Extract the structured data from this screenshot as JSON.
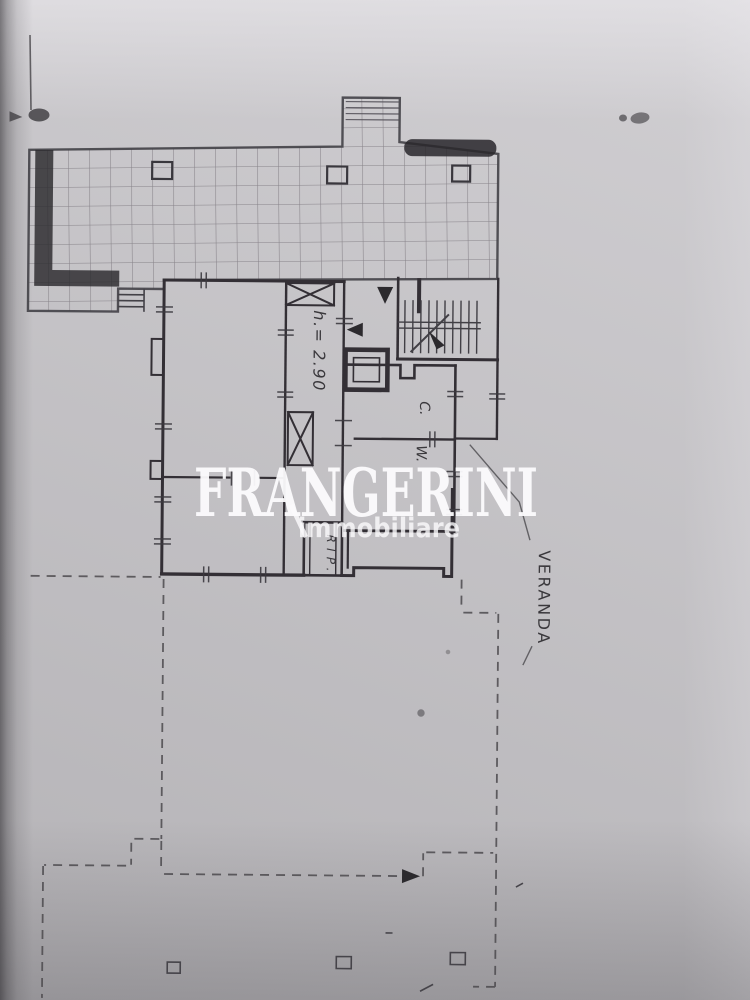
{
  "photo": {
    "description": "scanned architectural floor plan page"
  },
  "watermark": {
    "name": "FRANGERINI",
    "tagline": "immobiliare"
  },
  "labels": {
    "height": "h.= 2.90",
    "kitchen": "C.",
    "wc": "W.",
    "storage": "RIP.",
    "veranda": "VERANDA"
  },
  "colors": {
    "paper": "#c9c7cb",
    "ink": "#3a383c",
    "grid": "#8a868c",
    "parapet": "#2b292d",
    "dashed": "#4c4a4e",
    "watermark": "#fcfbfd"
  }
}
